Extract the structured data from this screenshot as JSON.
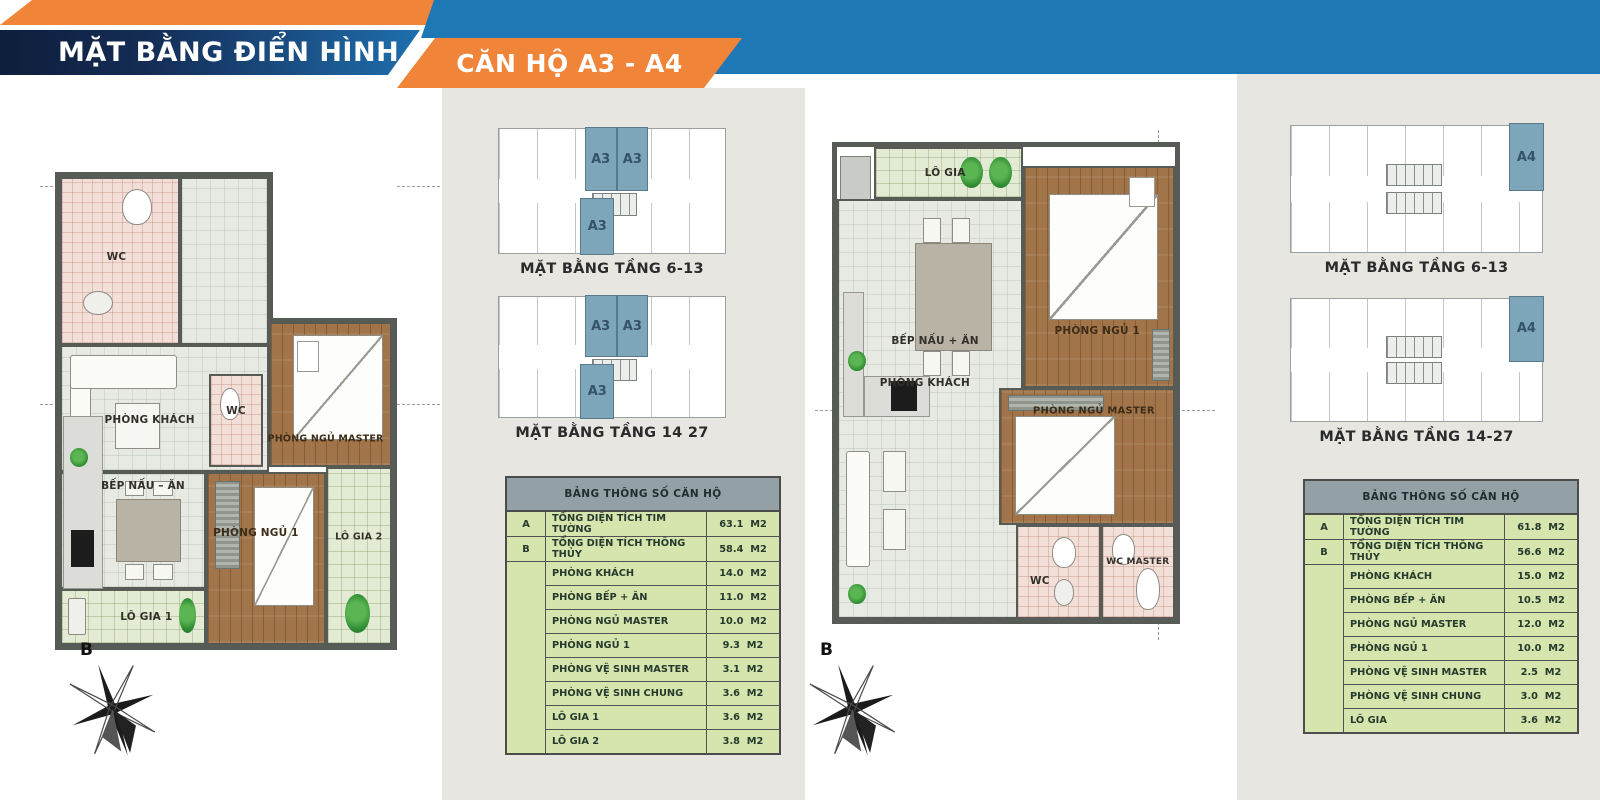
{
  "header": {
    "title": "MẶT BẰNG ĐIỂN HÌNH",
    "subtitle": "CĂN HỘ A3 - A4"
  },
  "colors": {
    "navy": "#0e1e3c",
    "blue": "#1e78b6",
    "orange": "#f08438",
    "band_gray": "#e8e6e1",
    "table_green": "#d5e5ad",
    "table_header_gray": "#93a0a5",
    "unit_highlight_blue": "#7ea6ba"
  },
  "a3": {
    "compass": "B",
    "rooms": {
      "wc1": "WC",
      "wc2": "WC",
      "living": "PHÒNG KHÁCH",
      "kitchen": "BẾP NẤU – ĂN",
      "master": "PHÒNG NGỦ MASTER",
      "bed1": "PHÒNG NGỦ 1",
      "logia1": "LÔ GIA 1",
      "logia2": "LÔ GIA 2"
    },
    "keyplans": [
      {
        "caption": "MẶT BẰNG TẦNG 6-13",
        "units": [
          "A3",
          "A3",
          "A3"
        ]
      },
      {
        "caption": "MẶT BẰNG TẦNG 14 27",
        "units": [
          "A3",
          "A3",
          "A3"
        ]
      }
    ],
    "table": {
      "title": "BẢNG THÔNG SỐ CĂN HỘ",
      "rows": [
        {
          "key": "A",
          "label": "TỔNG DIỆN TÍCH TIM TƯỜNG",
          "value": "63.1",
          "unit": "M2"
        },
        {
          "key": "B",
          "label": "TỔNG DIỆN TÍCH THÔNG THỦY",
          "value": "58.4",
          "unit": "M2"
        },
        {
          "key": "",
          "label": "PHÒNG KHÁCH",
          "value": "14.0",
          "unit": "M2"
        },
        {
          "key": "",
          "label": "PHÒNG BẾP + ĂN",
          "value": "11.0",
          "unit": "M2"
        },
        {
          "key": "",
          "label": "PHÒNG NGỦ MASTER",
          "value": "10.0",
          "unit": "M2"
        },
        {
          "key": "",
          "label": "PHÒNG NGỦ 1",
          "value": "9.3",
          "unit": "M2"
        },
        {
          "key": "",
          "label": "PHÒNG VỆ SINH MASTER",
          "value": "3.1",
          "unit": "M2"
        },
        {
          "key": "",
          "label": "PHÒNG VỆ SINH CHUNG",
          "value": "3.6",
          "unit": "M2"
        },
        {
          "key": "",
          "label": "LÔ GIA 1",
          "value": "3.6",
          "unit": "M2"
        },
        {
          "key": "",
          "label": "LÔ GIA 2",
          "value": "3.8",
          "unit": "M2"
        }
      ]
    }
  },
  "a4": {
    "compass": "B",
    "rooms": {
      "logia": "LÔ GIA",
      "kitchen": "BẾP NẤU + ĂN",
      "living": "PHÒNG KHÁCH",
      "bed1": "PHÒNG NGỦ 1",
      "master": "PHÒNG NGỦ MASTER",
      "wc": "WC",
      "wc_master": "WC MASTER"
    },
    "keyplans": [
      {
        "caption": "MẶT BẰNG TẦNG 6-13",
        "units": [
          "A4"
        ]
      },
      {
        "caption": "MẶT BẰNG TẦNG 14-27",
        "units": [
          "A4"
        ]
      }
    ],
    "table": {
      "title": "BẢNG THÔNG SỐ CĂN HỘ",
      "rows": [
        {
          "key": "A",
          "label": "TỔNG DIỆN TÍCH TIM TƯỜNG",
          "value": "61.8",
          "unit": "M2"
        },
        {
          "key": "B",
          "label": "TỔNG DIỆN TÍCH THÔNG THỦY",
          "value": "56.6",
          "unit": "M2"
        },
        {
          "key": "",
          "label": "PHÒNG KHÁCH",
          "value": "15.0",
          "unit": "M2"
        },
        {
          "key": "",
          "label": "PHÒNG BẾP + ĂN",
          "value": "10.5",
          "unit": "M2"
        },
        {
          "key": "",
          "label": "PHÒNG NGỦ MASTER",
          "value": "12.0",
          "unit": "M2"
        },
        {
          "key": "",
          "label": "PHÒNG NGỦ 1",
          "value": "10.0",
          "unit": "M2"
        },
        {
          "key": "",
          "label": "PHÒNG VỆ SINH MASTER",
          "value": "2.5",
          "unit": "M2"
        },
        {
          "key": "",
          "label": "PHÒNG VỆ SINH CHUNG",
          "value": "3.0",
          "unit": "M2"
        },
        {
          "key": "",
          "label": "LÔ GIA",
          "value": "3.6",
          "unit": "M2"
        }
      ]
    }
  }
}
